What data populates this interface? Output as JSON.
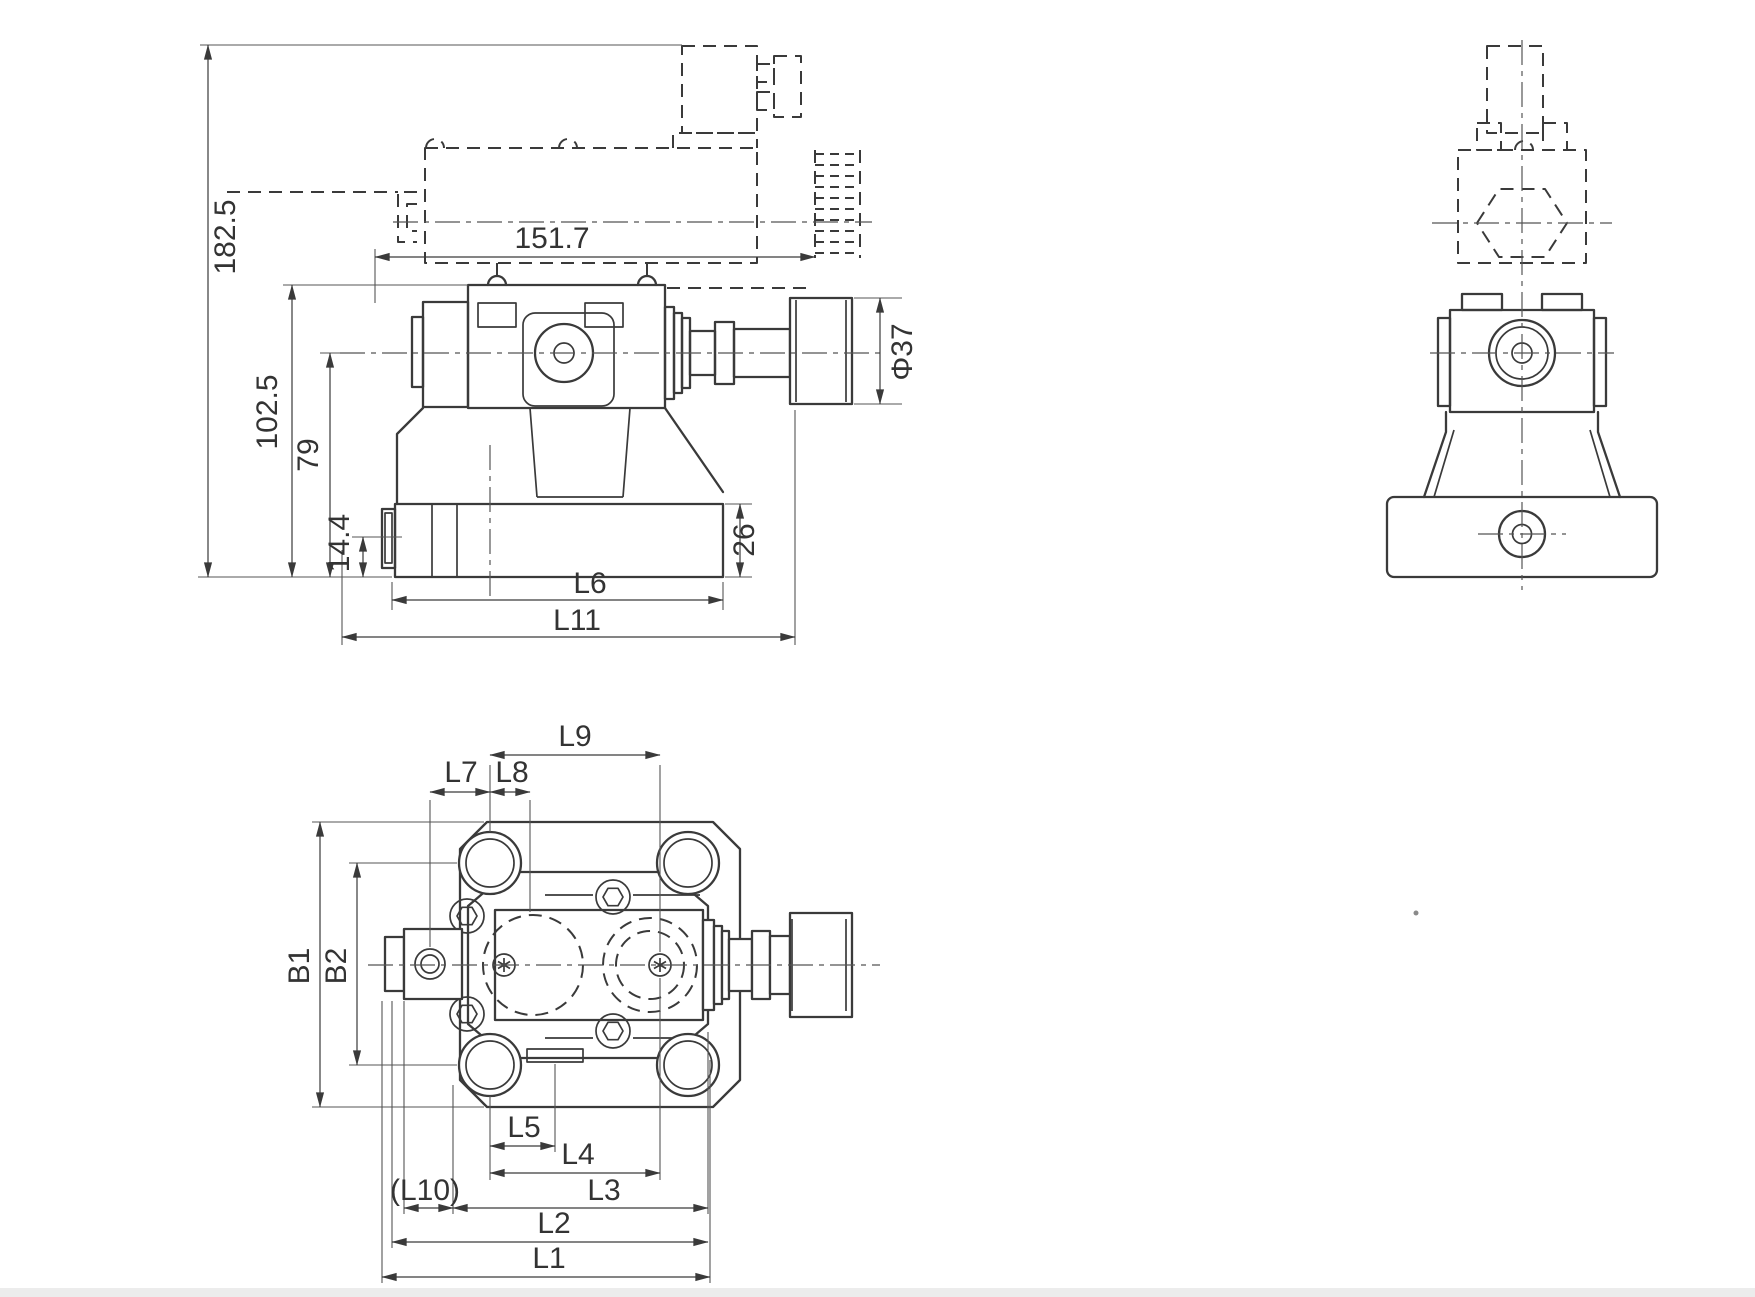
{
  "drawing": {
    "background": "#ffffff",
    "line_color": "#3a3a3a",
    "footer_strip_color": "#ececec",
    "front_view": {
      "dims": {
        "overall_height": "182.5",
        "body_top_height": "102.5",
        "axis_height": "79",
        "port_height": "14.4",
        "solenoid_length": "151.7",
        "knob_diameter": "Φ37",
        "base_height": "26",
        "base_length": "L6",
        "overall_length": "L11"
      }
    },
    "top_view": {
      "dims": {
        "l9": "L9",
        "l7": "L7",
        "l8": "L8",
        "b1": "B1",
        "b2": "B2",
        "l5": "L5",
        "l4": "L4",
        "l3": "L3",
        "l10": "(L10)",
        "l2": "L2",
        "l1": "L1"
      }
    }
  }
}
